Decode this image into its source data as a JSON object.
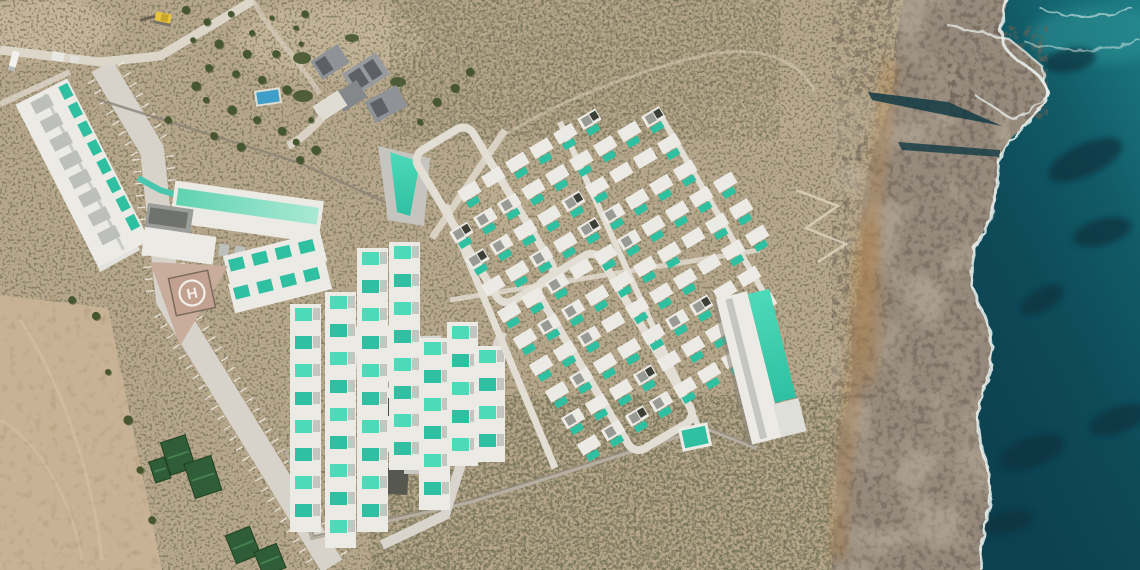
{
  "scene": {
    "helipad": {
      "letter": "H",
      "cx": 192,
      "cy": 293,
      "rotation": -12
    },
    "colors": {
      "scrub": "#b7a78c",
      "scrubDark": "#5d6044",
      "field": "#c7b295",
      "road": "#d7d3cb",
      "roadMinor": "#dcd6c9",
      "walk": "#e3ded4",
      "building": "#eceae5",
      "buildingGray": "#bcbfbc",
      "roofMed": "#8f9296",
      "roofDark": "#5d6166",
      "pool": "#2fc0a2",
      "poolBright": "#4cdab9",
      "mint1": "#5fd3b1",
      "mint2": "#a9e9d3",
      "wallDark": "#8a8376",
      "helipadPad": "#c9ad9c",
      "helipadSq": "#c2a191",
      "heliMark": "#f2efe8",
      "rock": "#968a7c",
      "rockDark": "#6c6154",
      "rockLight": "#c4b8a6",
      "orange": "#b08147",
      "ocean1": "#1c7b83",
      "ocean2": "#115a66",
      "ocean3": "#0e4a58",
      "ocean4": "#0d4150",
      "reef": "#07323c",
      "foam": "#eef6f3",
      "bluePool": "#3f9fc9",
      "tarp": "#2f5d38",
      "tarpLight": "#47804f",
      "tree": "#46562f",
      "excavator": "#e8c53c"
    },
    "villaField": {
      "origin": [
        446,
        206
      ],
      "angle": -31,
      "dx": 28,
      "dy": 31,
      "cols": 13,
      "rows": 10,
      "poly": [
        [
          447,
          196
        ],
        [
          556,
          117
        ],
        [
          668,
          113
        ],
        [
          757,
          218
        ],
        [
          776,
          300
        ],
        [
          706,
          432
        ],
        [
          558,
          472
        ],
        [
          466,
          444
        ],
        [
          440,
          330
        ]
      ]
    },
    "hotelSlabPools": {
      "origin": [
        60,
        82
      ],
      "angle": 63,
      "count": 8,
      "step": 21
    },
    "unitStrips": [
      {
        "x": 228,
        "y": 260,
        "n": 4,
        "step": 24,
        "dir": "h"
      },
      {
        "x": 233,
        "y": 288,
        "n": 4,
        "step": 24,
        "dir": "h"
      },
      {
        "x": 295,
        "y": 308,
        "n": 8,
        "step": 28,
        "dir": "v"
      },
      {
        "x": 330,
        "y": 296,
        "n": 9,
        "step": 28,
        "dir": "v"
      },
      {
        "x": 362,
        "y": 252,
        "n": 10,
        "step": 28,
        "dir": "v"
      },
      {
        "x": 394,
        "y": 246,
        "n": 8,
        "step": 28,
        "dir": "v"
      },
      {
        "x": 424,
        "y": 342,
        "n": 6,
        "step": 28,
        "dir": "v"
      },
      {
        "x": 452,
        "y": 326,
        "n": 5,
        "step": 28,
        "dir": "v"
      },
      {
        "x": 479,
        "y": 350,
        "n": 4,
        "step": 28,
        "dir": "v"
      }
    ],
    "mainRoad": {
      "pts": [
        [
          102,
          66
        ],
        [
          152,
          150
        ],
        [
          168,
          300
        ],
        [
          332,
          566
        ]
      ],
      "width": 24,
      "tickStep": 12
    },
    "trees": [
      [
        186,
        10
      ],
      [
        207,
        22
      ],
      [
        231,
        14
      ],
      [
        252,
        33
      ],
      [
        272,
        18
      ],
      [
        296,
        28
      ],
      [
        219,
        44
      ],
      [
        247,
        54
      ],
      [
        276,
        54
      ],
      [
        301,
        44
      ],
      [
        209,
        68
      ],
      [
        236,
        74
      ],
      [
        262,
        80
      ],
      [
        287,
        90
      ],
      [
        206,
        100
      ],
      [
        232,
        110
      ],
      [
        257,
        120
      ],
      [
        282,
        131
      ],
      [
        214,
        136
      ],
      [
        241,
        147
      ],
      [
        193,
        40
      ],
      [
        196,
        86
      ],
      [
        168,
        120
      ],
      [
        305,
        14
      ],
      [
        311,
        120
      ],
      [
        296,
        142
      ],
      [
        420,
        122
      ],
      [
        437,
        102
      ],
      [
        455,
        88
      ],
      [
        470,
        72
      ],
      [
        300,
        160
      ],
      [
        316,
        150
      ],
      [
        72,
        300
      ],
      [
        96,
        316
      ],
      [
        128,
        420
      ],
      [
        140,
        470
      ],
      [
        108,
        372
      ],
      [
        152,
        520
      ]
    ],
    "tarps": [
      [
        178,
        455,
        26,
        34,
        -18
      ],
      [
        203,
        477,
        28,
        36,
        -18
      ],
      [
        160,
        470,
        16,
        22,
        -18
      ],
      [
        243,
        545,
        26,
        30,
        -22
      ],
      [
        270,
        560,
        24,
        26,
        -22
      ]
    ],
    "reefs": [
      [
        1085,
        160,
        40,
        16,
        -25
      ],
      [
        1102,
        232,
        30,
        13,
        -15
      ],
      [
        1042,
        300,
        24,
        11,
        -30
      ],
      [
        1032,
        452,
        34,
        15,
        -20
      ],
      [
        1008,
        522,
        26,
        11,
        -15
      ],
      [
        1118,
        420,
        30,
        13,
        -20
      ],
      [
        1070,
        60,
        26,
        12,
        -10
      ]
    ],
    "seed": 7
  }
}
